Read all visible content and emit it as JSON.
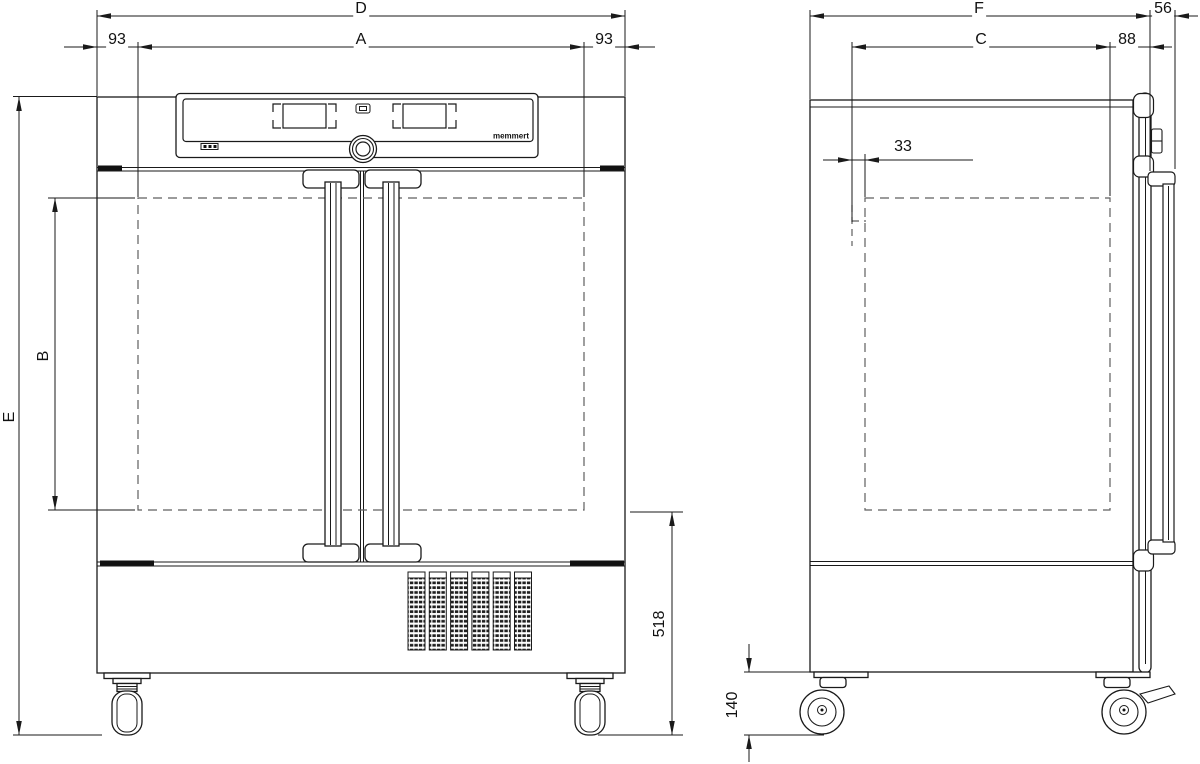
{
  "brand_label": "memmert",
  "dimensions": {
    "front": {
      "overall_width": "D",
      "interior_width": "A",
      "left_inset": "93",
      "right_inset": "93",
      "overall_height": "E",
      "interior_height": "B",
      "floor_to_chamber": "518"
    },
    "side": {
      "overall_depth": "F",
      "handle_projection": "56",
      "interior_depth": "C",
      "door_thickness": "88",
      "rear_clearance": "33",
      "caster_height": "140"
    }
  }
}
